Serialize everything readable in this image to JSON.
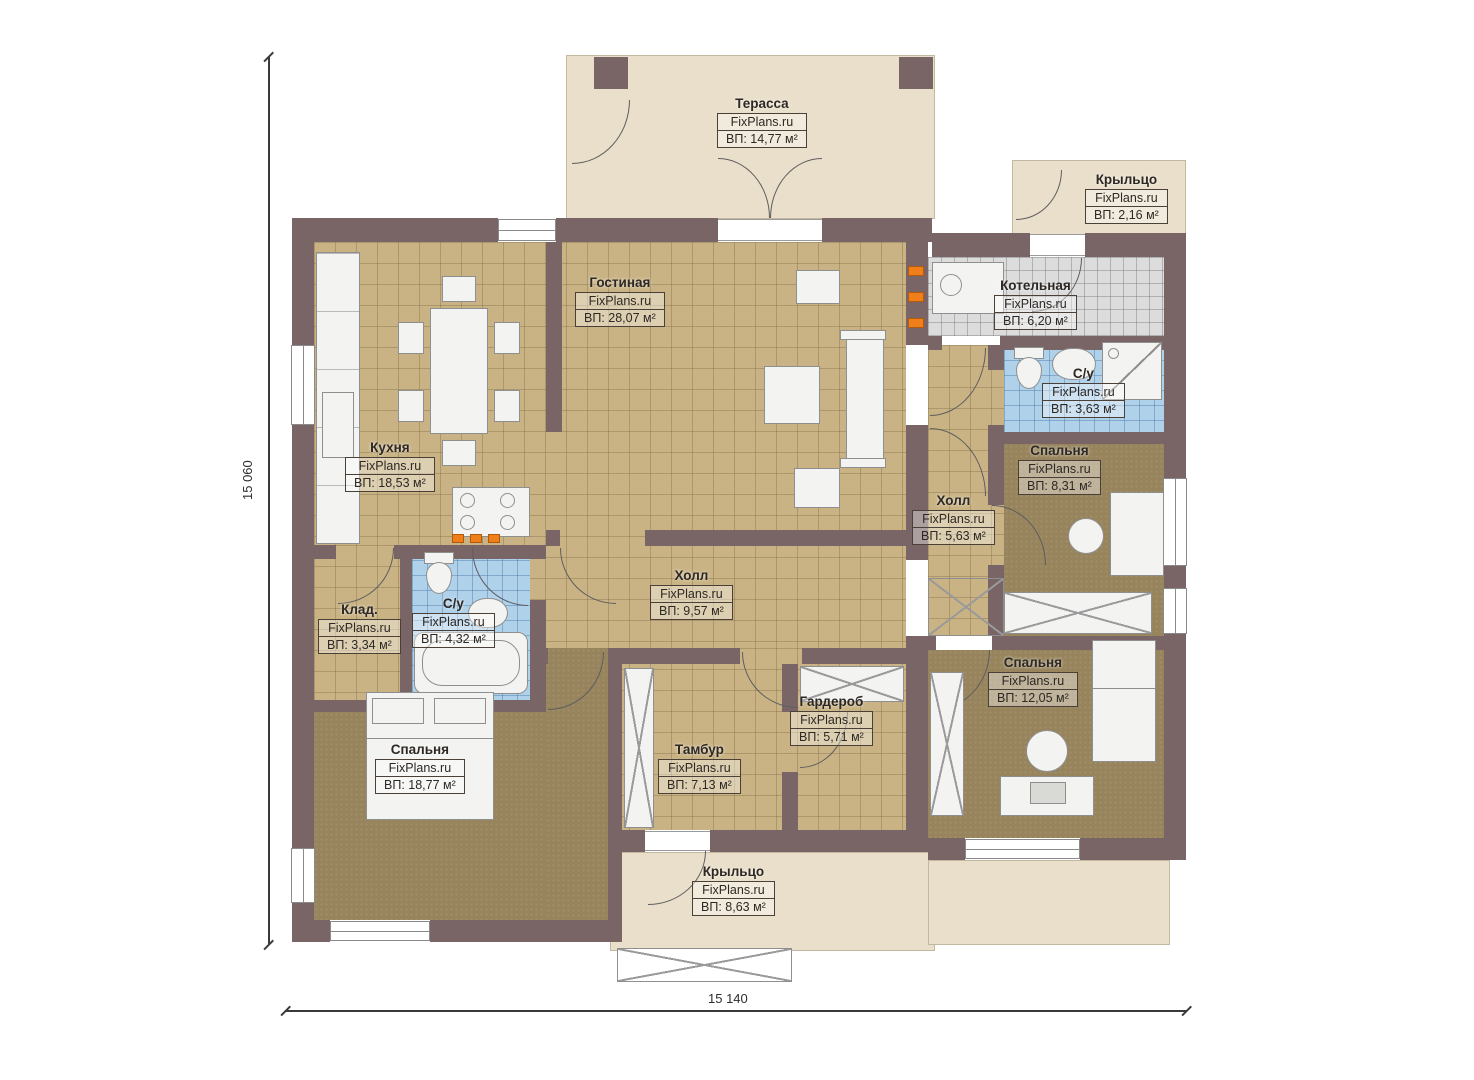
{
  "plan": {
    "brand": "FixPlans.ru",
    "dim_height": "15 060",
    "dim_width": "15 140",
    "rooms": [
      {
        "id": "terrace",
        "name": "Терасса",
        "area": "ВП: 14,77 м²"
      },
      {
        "id": "porch-top",
        "name": "Крыльцо",
        "area": "ВП: 2,16 м²"
      },
      {
        "id": "living-room",
        "name": "Гостиная",
        "area": "ВП: 28,07 м²"
      },
      {
        "id": "boiler-room",
        "name": "Котельная",
        "area": "ВП: 6,20 м²"
      },
      {
        "id": "bathroom-right",
        "name": "С/у",
        "area": "ВП: 3,63 м²"
      },
      {
        "id": "kitchen",
        "name": "Кухня",
        "area": "ВП: 18,53 м²"
      },
      {
        "id": "bedroom-right",
        "name": "Спальня",
        "area": "ВП: 8,31 м²"
      },
      {
        "id": "hall-right",
        "name": "Холл",
        "area": "ВП: 5,63 м²"
      },
      {
        "id": "hall-main",
        "name": "Холл",
        "area": "ВП: 9,57 м²"
      },
      {
        "id": "storage",
        "name": "Клад.",
        "area": "ВП: 3,34 м²"
      },
      {
        "id": "bathroom-left",
        "name": "С/у",
        "area": "ВП: 4,32 м²"
      },
      {
        "id": "wardrobe-room",
        "name": "Гардероб",
        "area": "ВП: 5,71 м²"
      },
      {
        "id": "bedroom-se",
        "name": "Спальня",
        "area": "ВП: 12,05 м²"
      },
      {
        "id": "bedroom-sw",
        "name": "Спальня",
        "area": "ВП: 18,77 м²"
      },
      {
        "id": "vestibule",
        "name": "Тамбур",
        "area": "ВП: 7,13 м²"
      },
      {
        "id": "porch-bottom",
        "name": "Крыльцо",
        "area": "ВП: 8,63 м²"
      }
    ]
  }
}
